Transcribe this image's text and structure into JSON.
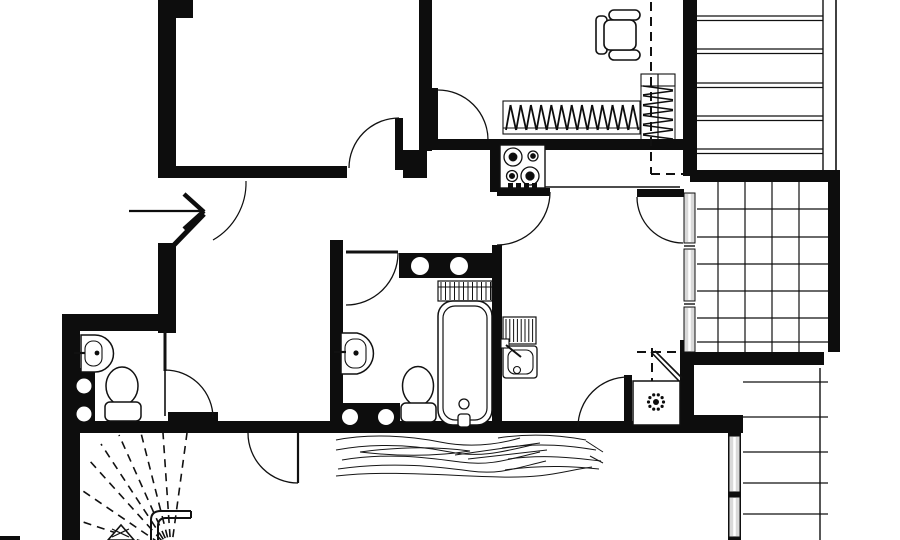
{
  "meta": {
    "kind": "apartment-floor-plan",
    "description": "Black and white architectural floor plan of an apartment, no text labels visible",
    "width_px": 900,
    "height_px": 540
  },
  "palette": {
    "background": "#ffffff",
    "wall": "#0d0d0d",
    "line": "#111111",
    "window_fill": "#d9d9d9"
  },
  "rooms": {
    "bathroom": {
      "fixtures": [
        "bathtub",
        "towel-radiator",
        "toilet",
        "wall-sink",
        "plumbing-duct-top",
        "plumbing-duct-bottom"
      ]
    },
    "wc": {
      "fixtures": [
        "toilet",
        "wall-sink",
        "plumbing-duct"
      ]
    },
    "kitchen": {
      "fixtures": [
        "gas-stove-4-burner",
        "sink-with-drainer",
        "counter",
        "corner-boiler-cabinet"
      ]
    },
    "top-right-room": {
      "fixtures": [
        "office-chair",
        "radiator-horizontal",
        "radiator-vertical",
        "dashed-overhead-line"
      ]
    },
    "terrace": {
      "floor": "tile-grid",
      "grid_columns": 5,
      "grid_rows": 7,
      "glazing_segments": 3
    },
    "stairwell": {
      "fixtures": [
        "fan-shaped-dashed-steps",
        "handrail",
        "direction-triangle"
      ]
    },
    "hallway": {
      "fixtures": [
        "entrance-arrow"
      ]
    }
  },
  "door_swings_count": 9,
  "windows": [
    "terrace-glazing-strip",
    "lower-right-window-strip"
  ],
  "floor_texture": "wood-grain band below bathroom and kitchen",
  "exterior": [
    "plank-lines-top-right",
    "plank-lines-bottom-right"
  ]
}
